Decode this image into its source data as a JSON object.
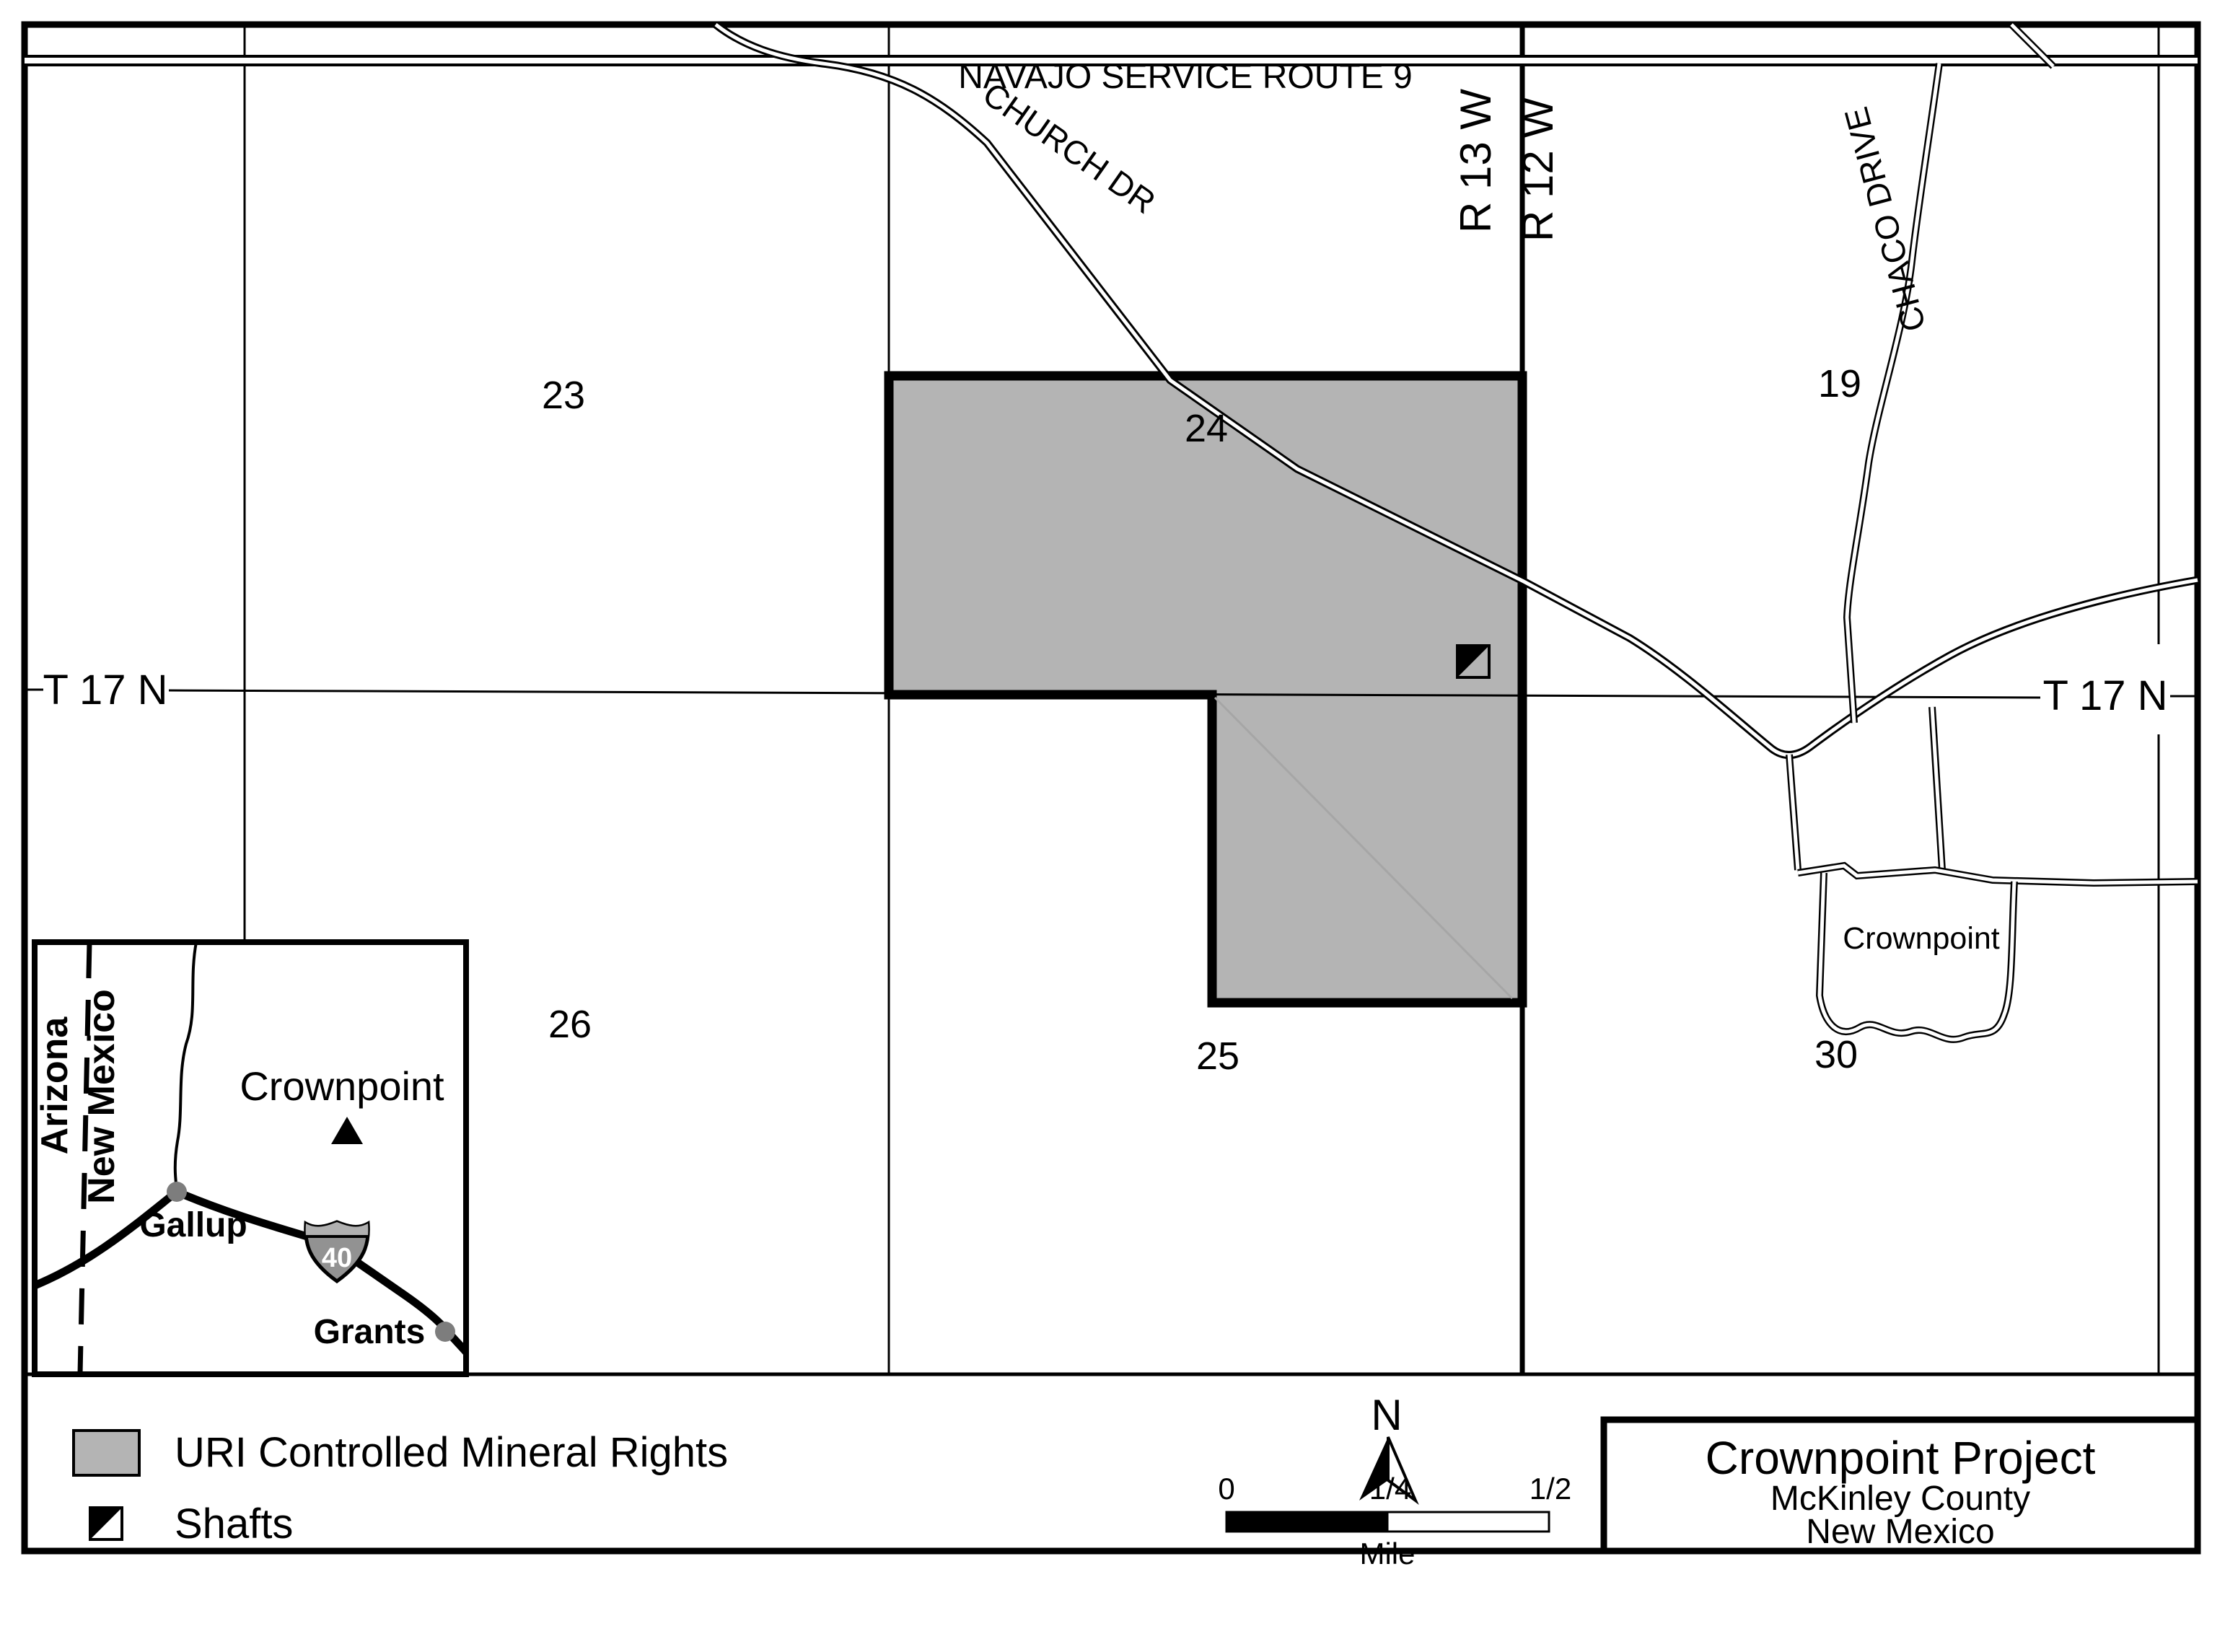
{
  "colors": {
    "parcel_gray": "#b4b4b4",
    "legend_gray": "#b4b4b4",
    "muted_gray_text": "#7d7d7d",
    "shield_body": "#929292",
    "shield_band": "#b0b0b0",
    "line_black": "#000000"
  },
  "map": {
    "roads": {
      "navajo": "NAVAJO SERVICE ROUTE 9",
      "church": "CHURCH DR",
      "chaco": "CHACO DRIVE"
    },
    "township_left": "T 17 N",
    "township_right": "T 17 N",
    "range_west": "R 13 W",
    "range_east": "R 12 W",
    "sections": {
      "s23": "23",
      "s24": "24",
      "s19": "19",
      "s26": "26",
      "s25": "25",
      "s30": "30"
    },
    "town_label": "Crownpoint"
  },
  "inset": {
    "state_left": "Arizona",
    "state_right": "New Mexico",
    "crownpoint": "Crownpoint",
    "gallup": "Gallup",
    "grants": "Grants",
    "interstate": "40"
  },
  "legend": {
    "uri_label": "URI Controlled Mineral Rights",
    "shafts_label": "Shafts"
  },
  "north_label": "N",
  "scale_bar": {
    "tick0": "0",
    "tick1": "1/4",
    "tick2": "1/2",
    "unit": "Mile"
  },
  "title_block": {
    "title": "Crownpoint Project",
    "county": "McKinley County",
    "state": "New Mexico"
  }
}
